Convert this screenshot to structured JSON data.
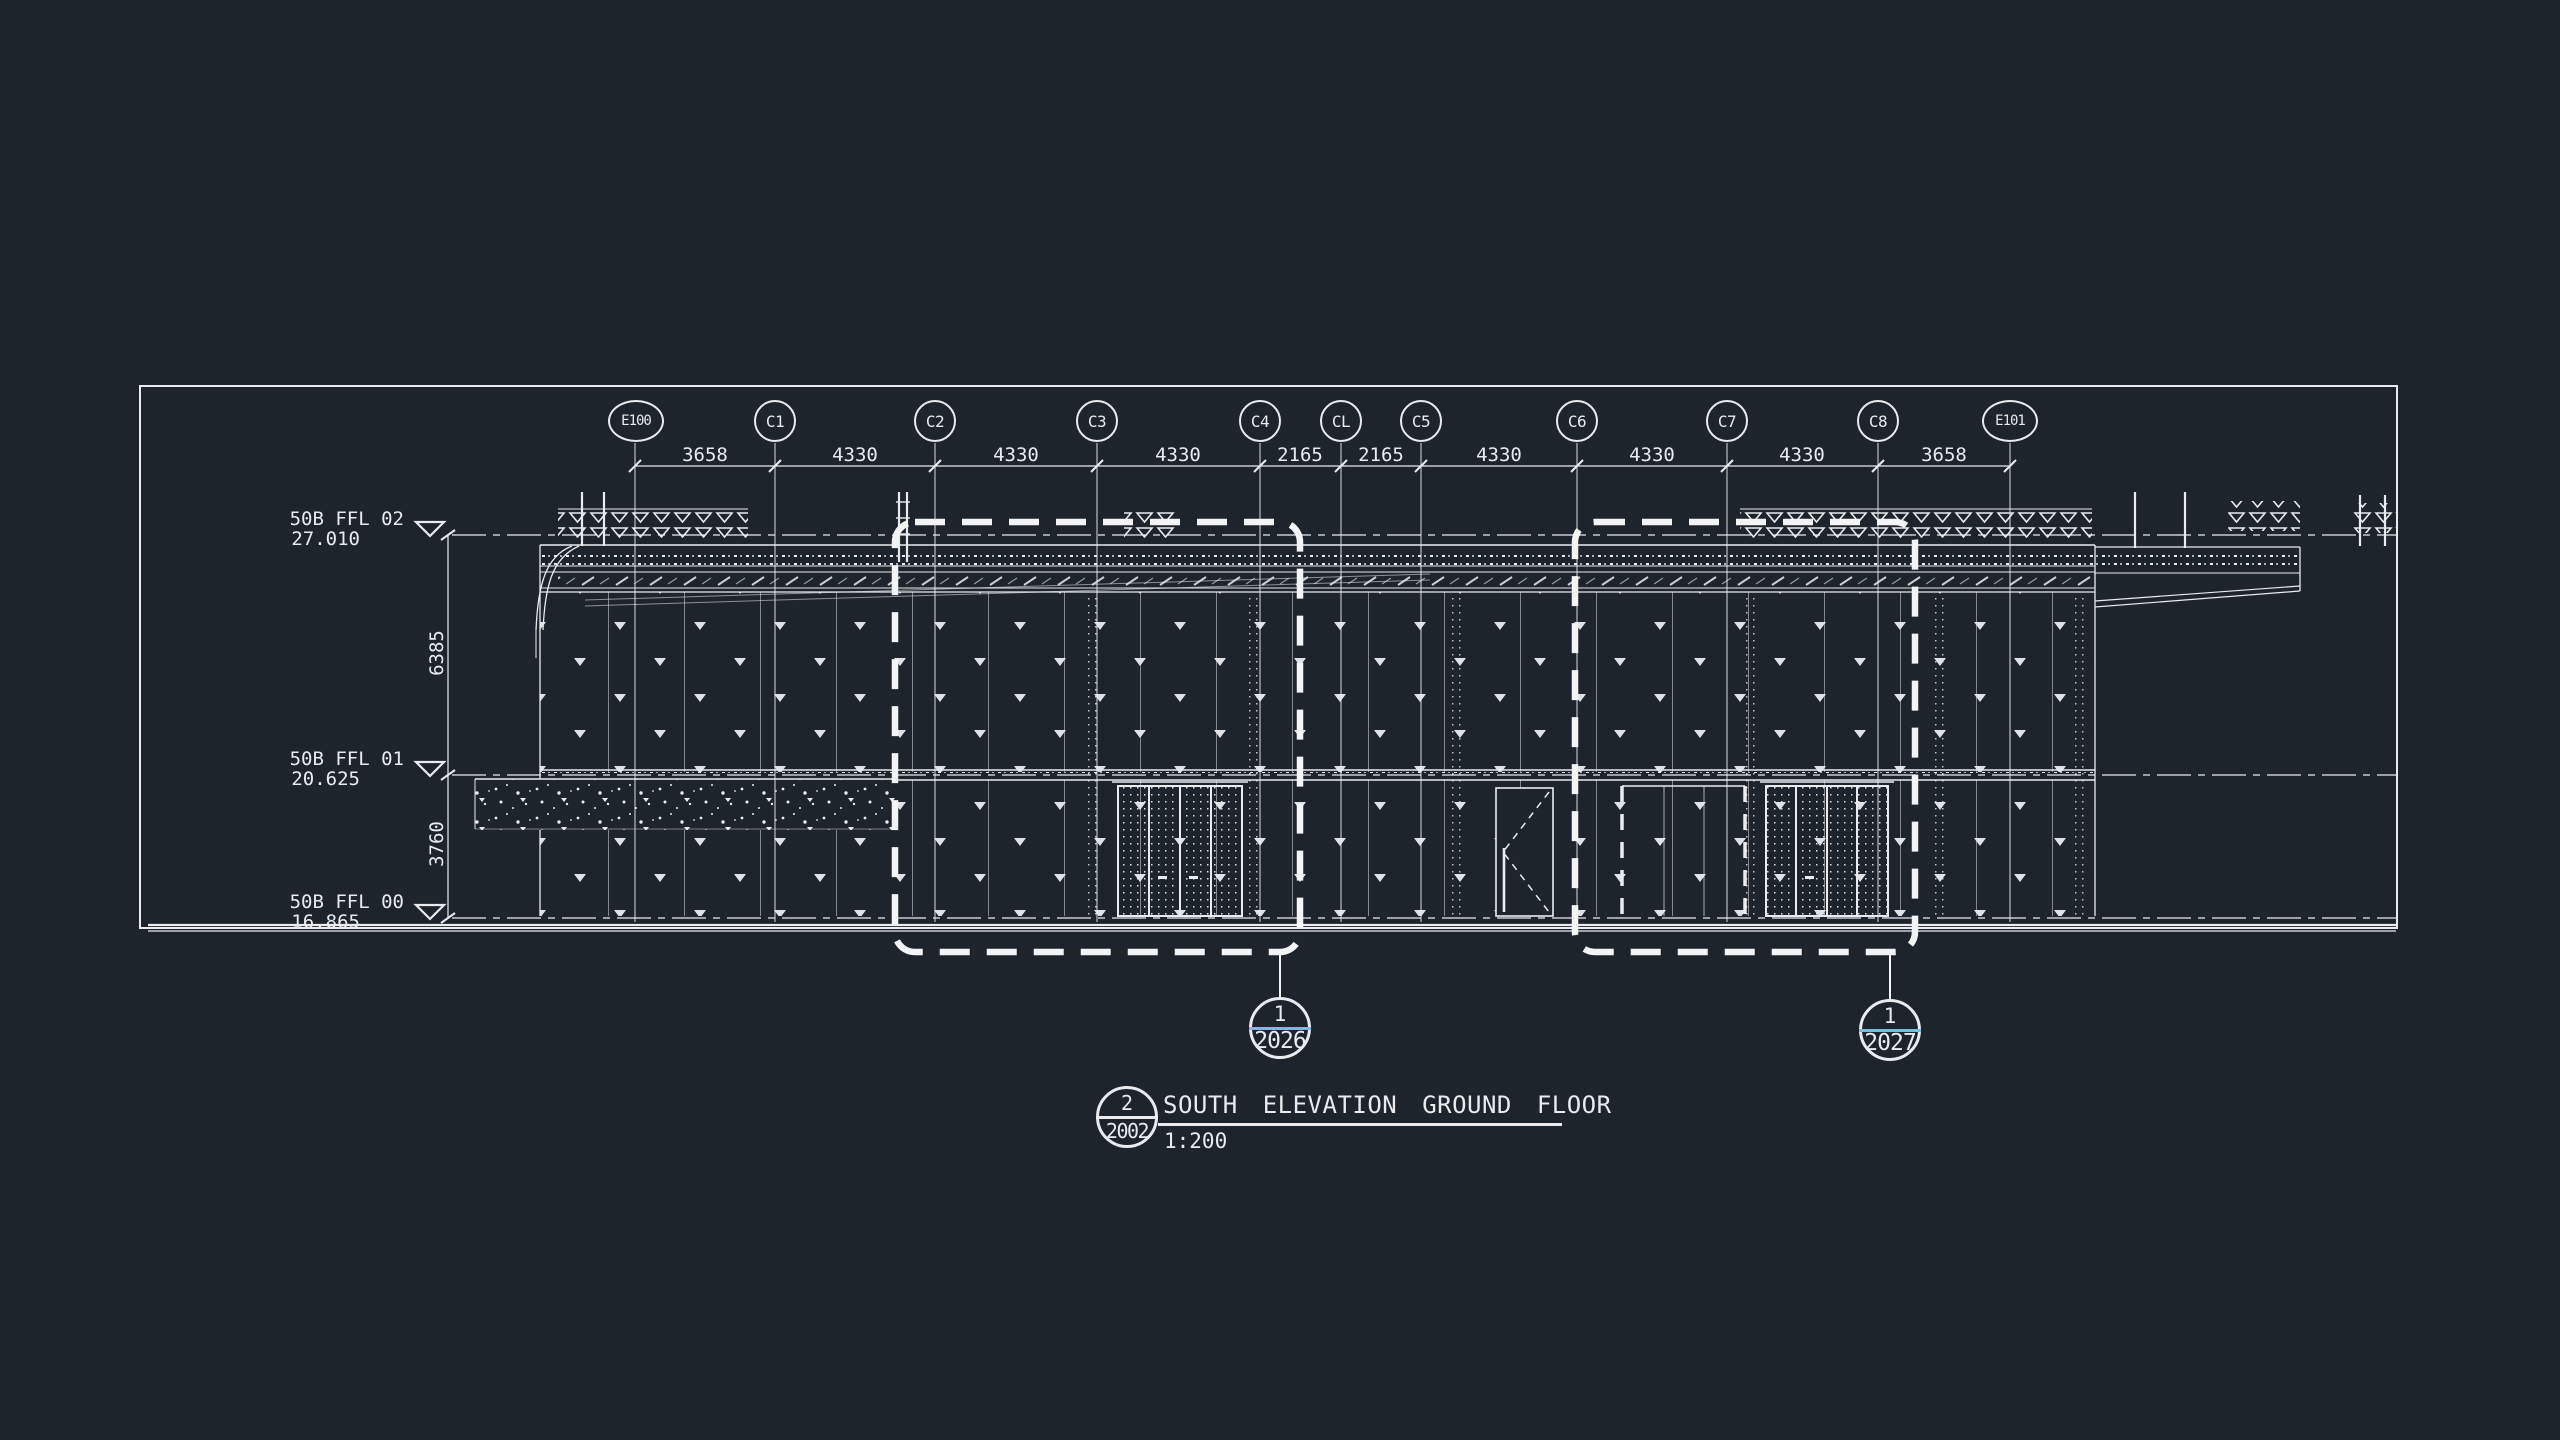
{
  "drawing": {
    "title_block": {
      "detail_number": "2",
      "sheet_number": "2002",
      "title": "SOUTH ELEVATION GROUND FLOOR",
      "scale": "1:200"
    },
    "grid": {
      "labels": [
        "E100",
        "C1",
        "C2",
        "C3",
        "C4",
        "CL",
        "C5",
        "C6",
        "C7",
        "C8",
        "E101"
      ],
      "spacings_mm": [
        "3658",
        "4330",
        "4330",
        "4330",
        "2165",
        "2165",
        "4330",
        "4330",
        "4330",
        "3658"
      ]
    },
    "levels": [
      {
        "name": "50B FFL 02",
        "elevation": "27.010"
      },
      {
        "name": "50B FFL 01",
        "elevation": "20.625"
      },
      {
        "name": "50B FFL 00",
        "elevation": "16.865"
      }
    ],
    "vertical_dims": [
      "6385",
      "3760"
    ],
    "detail_callouts": [
      {
        "number": "1",
        "sheet": "2026"
      },
      {
        "number": "1",
        "sheet": "2027"
      }
    ],
    "colors": {
      "background": "#1e242c",
      "linework": "#e9ebee",
      "callout_divider": "#72bfe3"
    }
  }
}
